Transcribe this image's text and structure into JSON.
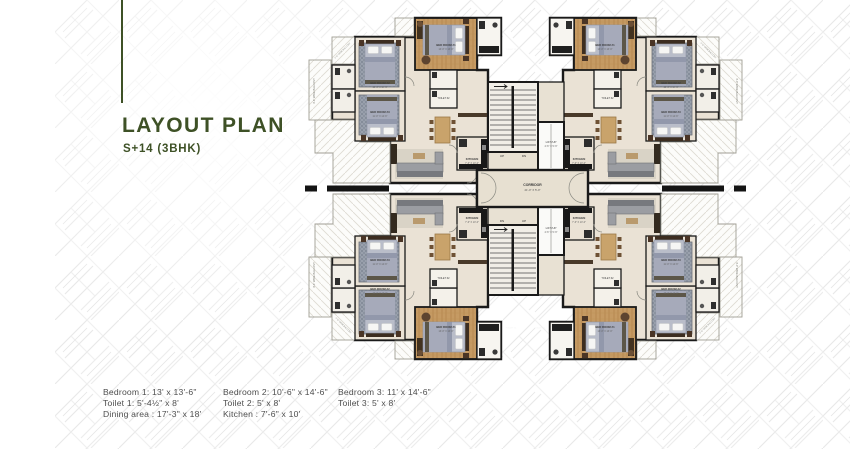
{
  "title_block": {
    "title": "LAYOUT PLAN",
    "subtitle": "S+14 (3BHK)"
  },
  "legend": {
    "columns": [
      {
        "lines": [
          "Bedroom 1: 13' x 13'-6\"",
          "Toilet 1: 5'-4½\" x 8'",
          "Dining area : 17'-3\" x 18'"
        ]
      },
      {
        "lines": [
          "Bedroom 2: 10'-6\" x 14'-6\"",
          "Toilet 2: 5' x 8'",
          "Kitchen : 7'-6\" x 10'"
        ]
      },
      {
        "lines": [
          "Bedroom 3: 11' x 14'-6\"",
          "Toilet 3: 5' x 8'"
        ]
      }
    ]
  },
  "plan": {
    "labels": {
      "corridor": "CORRIDOR",
      "corridor_dim": "21'-0\" X 5'-0\"",
      "lift": "LIFT/UP",
      "lift_dim": "4'-6\" X 5'-6\"",
      "up": "UP",
      "dn": "DN",
      "kitchen": "KITCHEN",
      "kitchen_dim": "7'-6\" X 10'-0\"",
      "bedroom1": "BED ROOM #1",
      "bedroom1_dim": "13'-0\" X 13'-6\"",
      "bedroom2": "BED ROOM #2",
      "bedroom2_dim": "10'-6\" X 14'-6\"",
      "bedroom3": "BED ROOM #3",
      "bedroom3_dim": "11'-0\" X 14'-6\"",
      "toilet": "TOILET #2",
      "toilet_dim": "5'-0\" X 8'-0\"",
      "ensuite": "TOILET #1",
      "ensuite_dim": "5'-4½\" X 8'-0\"",
      "balcony": "4'-0\" WIDE BALCONY",
      "dining": "DINING AREA",
      "entrance": "ENTRANCE FOYER"
    },
    "colors": {
      "accent_green": "#3e5126",
      "wall_black": "#1a1a1a",
      "floor_cream": "#eae2d5",
      "core_floor": "#e7e0d1",
      "wood": "#c59a63",
      "rug": "#99a0ac",
      "bed": "#b9bdc9",
      "balcony_white": "#fcfcfa",
      "legend_text": "#4e4e4e"
    }
  }
}
